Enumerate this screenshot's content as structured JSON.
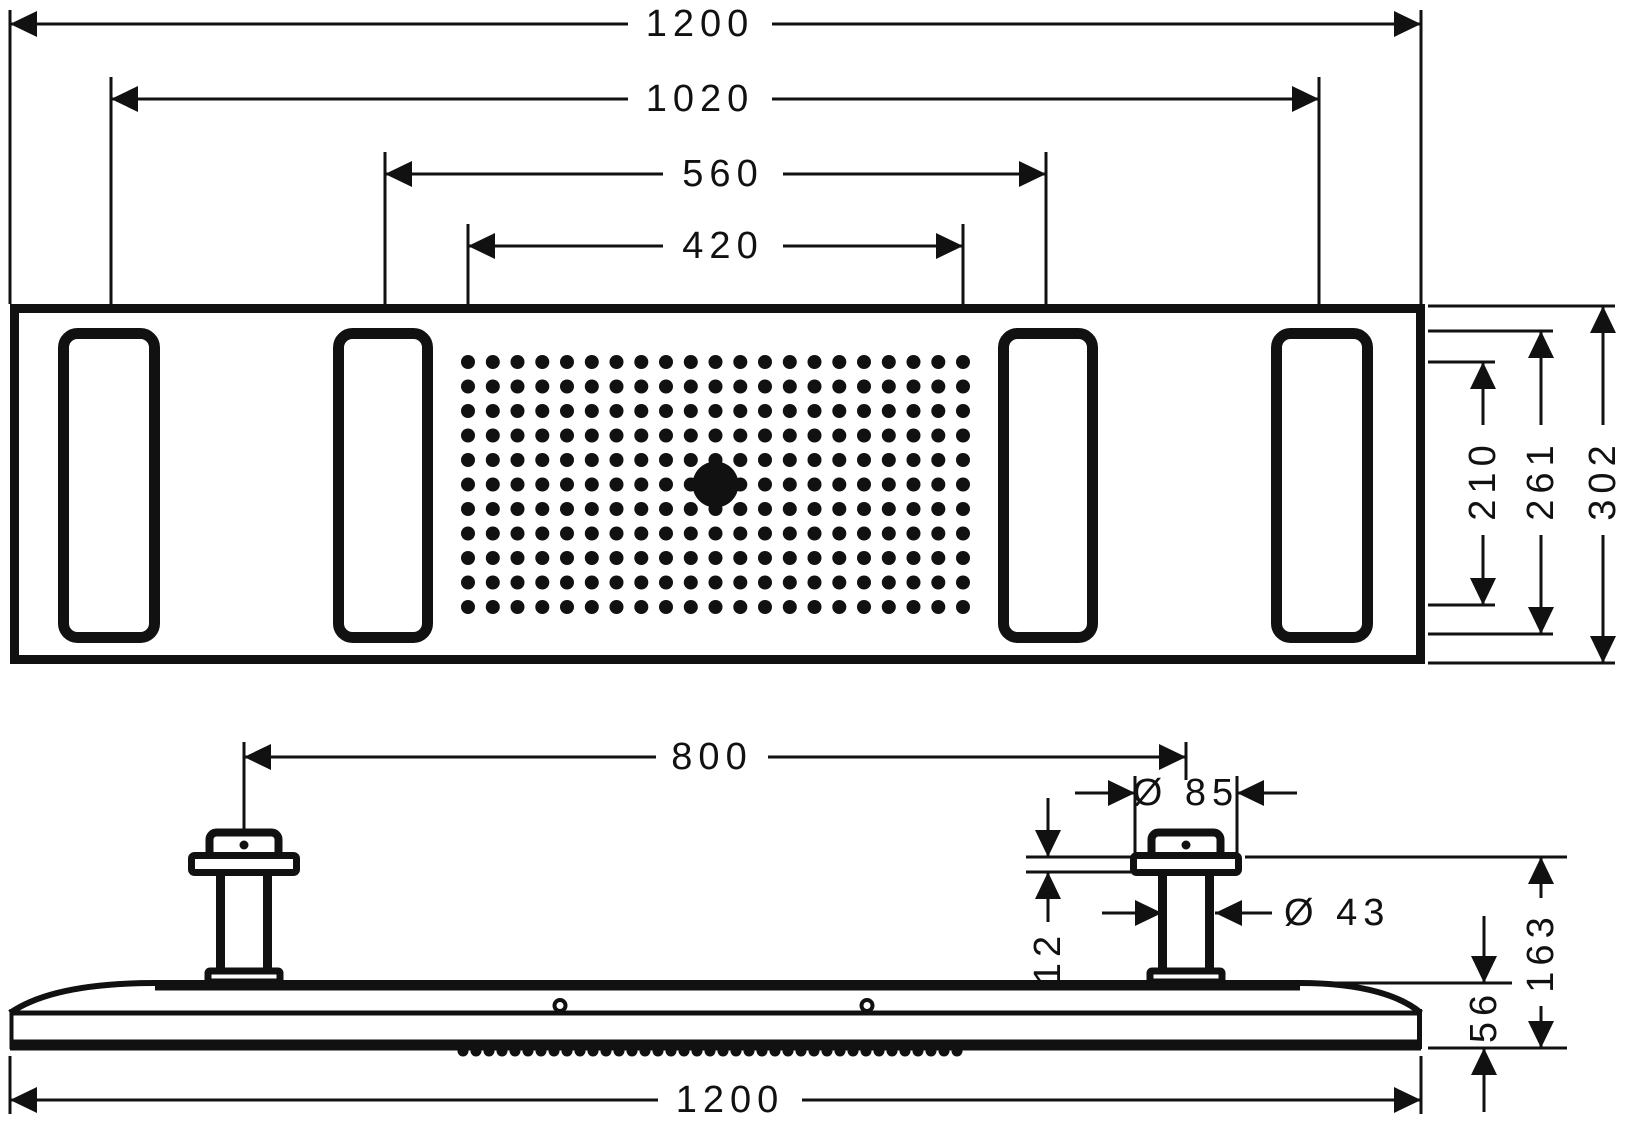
{
  "page": {
    "background": "#ffffff",
    "ink": "#111111"
  },
  "drawing": {
    "type": "technical-dimension-drawing",
    "subject": "overhead-shower-module-plan-and-side-elevation",
    "units": "mm",
    "plan": {
      "dims_horizontal": [
        {
          "label": "1200"
        },
        {
          "label": "1020"
        },
        {
          "label": "560"
        },
        {
          "label": "420"
        }
      ],
      "dims_vertical": [
        {
          "label": "210"
        },
        {
          "label": "261"
        },
        {
          "label": "302"
        }
      ],
      "slot_count": 4,
      "nozzle_grid": {
        "rows": 11,
        "cols": 21,
        "center_outlet": 1
      }
    },
    "side": {
      "dims": [
        {
          "label": "800"
        },
        {
          "label": "Ø 85"
        },
        {
          "label": "12"
        },
        {
          "label": "Ø 43"
        },
        {
          "label": "163"
        },
        {
          "label": "56"
        },
        {
          "label": "1200"
        }
      ],
      "column_count": 2
    }
  }
}
